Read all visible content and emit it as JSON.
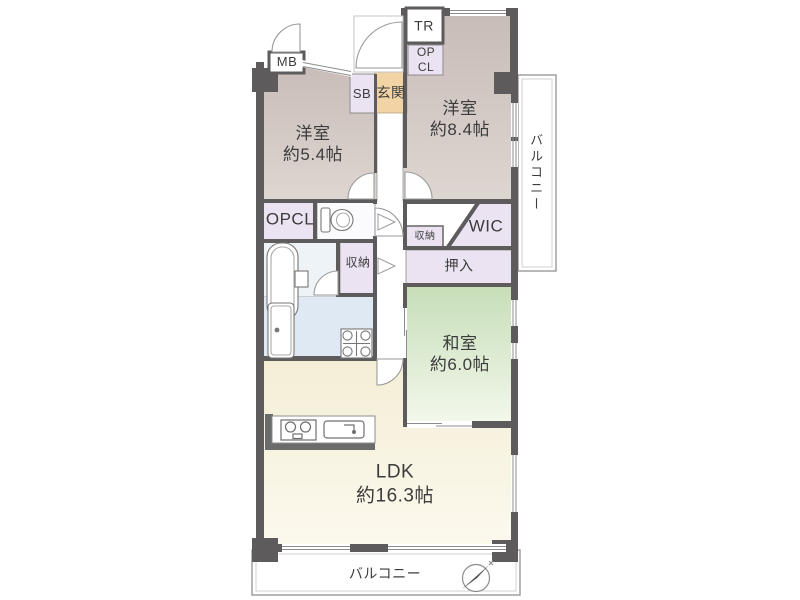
{
  "plan": {
    "title": "apartment-floor-plan",
    "rooms": {
      "yoshitsu1": {
        "name": "洋室",
        "size": "約5.4帖"
      },
      "yoshitsu2": {
        "name": "洋室",
        "size": "約8.4帖"
      },
      "washitsu": {
        "name": "和室",
        "size": "約6.0帖"
      },
      "ldk": {
        "name": "LDK",
        "size": "約16.3帖"
      },
      "genkan": {
        "label": "玄関"
      },
      "wic": {
        "label": "WIC"
      },
      "oshiire": {
        "label": "押入"
      },
      "opcl_hall": {
        "label": "OPCL"
      },
      "opcl_top": {
        "line1": "OP",
        "line2": "CL"
      },
      "sb": {
        "label": "SB"
      },
      "tr": {
        "label": "TR"
      },
      "mb": {
        "label": "MB"
      },
      "shuno_bath": {
        "label": "収納"
      },
      "shuno_wic": {
        "label": "収納"
      },
      "balcony_right": {
        "label": "バルコニー"
      },
      "balcony_bottom": {
        "label": "バルコニー"
      }
    },
    "icons": [
      "toilet-icon",
      "bathtub-icon",
      "vanity-icon",
      "washer-pan-icon",
      "stove-icon",
      "kitchen-sink-icon",
      "compass-icon"
    ],
    "colors": {
      "wall": "#5d5b5b",
      "thin": "#8d8d8d",
      "text": "#3c3c3c",
      "yoshitsu_top": "#c8bcb8",
      "yoshitsu_bottom": "#ded6d1",
      "washitsu_top": "#c7deb9",
      "washitsu_bottom": "#f3f8ec",
      "ldk_top": "#f4eed6",
      "ldk_bottom": "#fcf9ee",
      "genkan": "#f1d3a5",
      "closet": "#ebe3f1",
      "wet": "#dfe9f3",
      "bath": "#eef3f8",
      "balcony_border": "#9a9a9a"
    }
  }
}
